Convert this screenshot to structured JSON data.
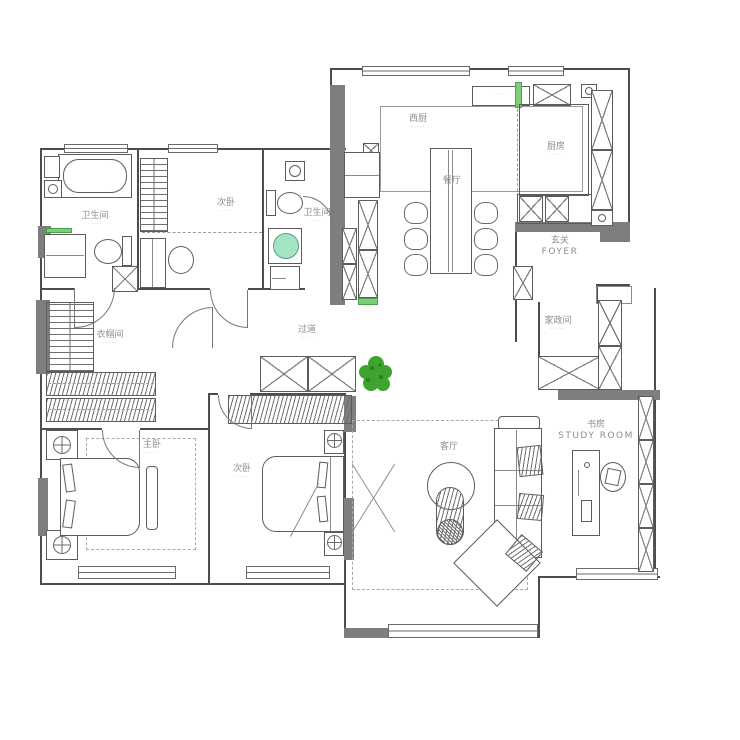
{
  "colors": {
    "wall_gray": "#7e7e7e",
    "line_dark": "#4d4d4d",
    "accent_green": "#7ccf7a",
    "appliance_green": "#a5e3c5",
    "plant_green": "#3fa32f",
    "label_gray": "#8d8d8d"
  },
  "rooms": {
    "bath1": {
      "label": "卫生间"
    },
    "bed2": {
      "label": "次卧"
    },
    "bath2": {
      "label": "卫生间"
    },
    "west_kitchen": {
      "label": "西厨"
    },
    "dining": {
      "label": "餐厅"
    },
    "kitchen": {
      "label": "厨房"
    },
    "foyer": {
      "label": "玄关",
      "sublabel": "FOYER"
    },
    "cloakroom": {
      "label": "衣帽间"
    },
    "hallway": {
      "label": "过道"
    },
    "utility": {
      "label": "家政间"
    },
    "master_bedroom": {
      "label": "主卧"
    },
    "bed3": {
      "label": "次卧"
    },
    "living": {
      "label": "客厅"
    },
    "study": {
      "label": "书房",
      "sublabel": "STUDY ROOM"
    }
  },
  "area_placeholder": "·····"
}
